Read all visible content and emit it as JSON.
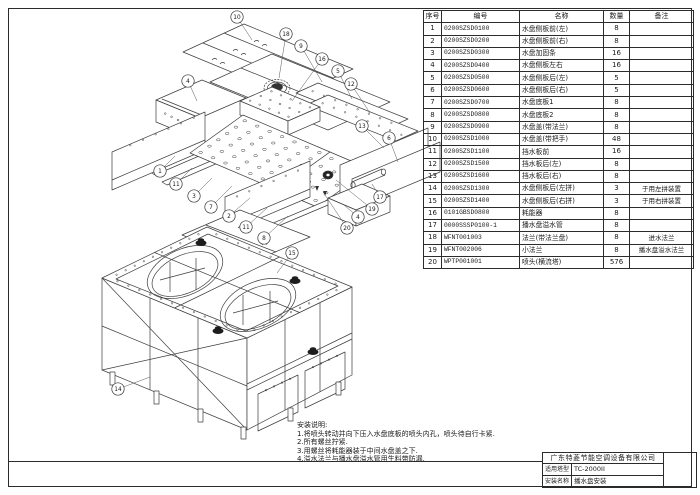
{
  "page": {
    "bg": "#ffffff",
    "line_color": "#3d3d3d",
    "frame_color": "#2b2b2b"
  },
  "parts_table": {
    "headers": [
      "序号",
      "编号",
      "名称",
      "数量",
      "备注"
    ],
    "rows": [
      [
        "1",
        "0200SZSD0100",
        "水盘侧板前(左)",
        "8",
        ""
      ],
      [
        "2",
        "0200SZSD0200",
        "水盘侧板前(右)",
        "8",
        ""
      ],
      [
        "3",
        "0200SZSD0300",
        "水盘加固条",
        "16",
        ""
      ],
      [
        "4",
        "0200SZSD0400",
        "水盘侧板左右",
        "16",
        ""
      ],
      [
        "5",
        "0200SZSD0500",
        "水盘侧板后(左)",
        "5",
        ""
      ],
      [
        "6",
        "0200SZSD0600",
        "水盘侧板后(右)",
        "5",
        ""
      ],
      [
        "7",
        "0200SZSD0700",
        "水盘底板1",
        "8",
        ""
      ],
      [
        "8",
        "0200SZSD0800",
        "水盘底板2",
        "8",
        ""
      ],
      [
        "9",
        "0200SZSD0900",
        "水盘盖(带法兰)",
        "8",
        ""
      ],
      [
        "10",
        "0200SZSD1000",
        "水盘盖(带把手)",
        "48",
        ""
      ],
      [
        "11",
        "0200SZSD1100",
        "挡水板前",
        "16",
        ""
      ],
      [
        "12",
        "0200SZSD1500",
        "挡水板后(左)",
        "8",
        ""
      ],
      [
        "13",
        "0200SZSD1600",
        "挡水板后(右)",
        "8",
        ""
      ],
      [
        "14",
        "0200SZSD1300",
        "水盘侧板后(左拼)",
        "3",
        "于用左拼装置"
      ],
      [
        "15",
        "0200SZSD1400",
        "水盘侧板后(右拼)",
        "3",
        "于用右拼装置"
      ],
      [
        "16",
        "0101GBSD0800",
        "耗能器",
        "8",
        ""
      ],
      [
        "17",
        "0000SSSP0100-1",
        "播水盘溢水管",
        "8",
        ""
      ],
      [
        "18",
        "WFNT001003",
        "法兰(带法兰盘)",
        "8",
        "进水法兰"
      ],
      [
        "19",
        "WFNT002006",
        "小法兰",
        "8",
        "播水盘溢水法兰"
      ],
      [
        "20",
        "WPTP001001",
        "喷头(横流塔)",
        "576",
        ""
      ]
    ]
  },
  "notes": {
    "title": "安装说明:",
    "lines": [
      "1.将喷头转动并向下压入水盘底板的喷头内孔，喷头待自行卡紧.",
      "2.所有螺丝拧紧.",
      "3.用螺丝将耗能器装于中间水盘盖之下.",
      "4.溢水法兰与播水盘溢水管用生料带防漏."
    ]
  },
  "title_block": {
    "company": "广东特菱节能空调设备有限公司",
    "model_label": "适用塔型",
    "model_value": "TC-2000II",
    "name_label": "安装名称",
    "name_value": "播水盘安装"
  },
  "diagram": {
    "exploded_balloons": [
      {
        "n": "10",
        "x": 237,
        "y": 17,
        "tx": 252,
        "ty": 40
      },
      {
        "n": "18",
        "x": 286,
        "y": 34,
        "tx": 279,
        "ty": 78
      },
      {
        "n": "9",
        "x": 301,
        "y": 46,
        "tx": 322,
        "ty": 82
      },
      {
        "n": "16",
        "x": 322,
        "y": 59,
        "tx": 292,
        "ty": 101
      },
      {
        "n": "5",
        "x": 338,
        "y": 71,
        "tx": 352,
        "ty": 99
      },
      {
        "n": "12",
        "x": 351,
        "y": 84,
        "tx": 370,
        "ty": 113
      },
      {
        "n": "4",
        "x": 188,
        "y": 81,
        "tx": 197,
        "ty": 101
      },
      {
        "n": "13",
        "x": 362,
        "y": 126,
        "tx": 384,
        "ty": 148
      },
      {
        "n": "6",
        "x": 389,
        "y": 138,
        "tx": 398,
        "ty": 162
      },
      {
        "n": "1",
        "x": 160,
        "y": 171,
        "tx": 175,
        "ty": 156
      },
      {
        "n": "11",
        "x": 176,
        "y": 184,
        "tx": 192,
        "ty": 168
      },
      {
        "n": "3",
        "x": 194,
        "y": 196,
        "tx": 212,
        "ty": 178
      },
      {
        "n": "7",
        "x": 211,
        "y": 207,
        "tx": 232,
        "ty": 186
      },
      {
        "n": "2",
        "x": 229,
        "y": 216,
        "tx": 250,
        "ty": 198
      },
      {
        "n": "11",
        "x": 246,
        "y": 227,
        "tx": 267,
        "ty": 208
      },
      {
        "n": "8",
        "x": 264,
        "y": 238,
        "tx": 288,
        "ty": 216
      },
      {
        "n": "17",
        "x": 380,
        "y": 197,
        "tx": 372,
        "ty": 184
      },
      {
        "n": "19",
        "x": 372,
        "y": 209,
        "tx": 336,
        "ty": 180
      },
      {
        "n": "4",
        "x": 358,
        "y": 217,
        "tx": 344,
        "ty": 205
      },
      {
        "n": "20",
        "x": 347,
        "y": 228,
        "tx": 323,
        "ty": 192
      }
    ],
    "assembly_balloons": [
      {
        "n": "14",
        "x": 118,
        "y": 389,
        "tx": 150,
        "ty": 377
      },
      {
        "n": "15",
        "x": 292,
        "y": 253,
        "tx": 277,
        "ty": 273
      }
    ]
  }
}
